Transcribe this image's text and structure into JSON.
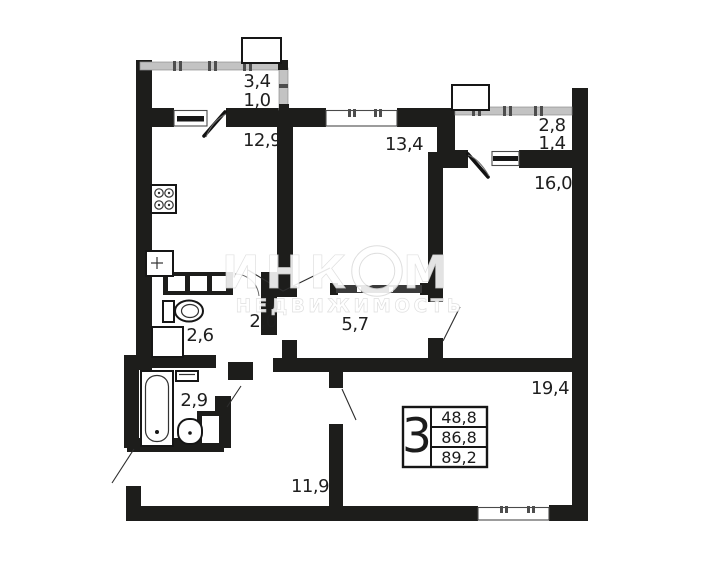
{
  "watermark": {
    "brand_left": "ИНК",
    "brand_right": "М",
    "subtitle": "НЕДВИЖИМОСТЬ"
  },
  "summary": {
    "room_count": "3",
    "living_area": "48,8",
    "apartment_area": "86,8",
    "total_area": "89,2"
  },
  "rooms": {
    "balcony_left": {
      "area": "3,4",
      "area_reduced": "1,0"
    },
    "kitchen": {
      "area": "12,9"
    },
    "bedroom": {
      "area": "13,4"
    },
    "balcony_right": {
      "area": "2,8",
      "area_reduced": "1,4"
    },
    "room_right": {
      "area": "16,0"
    },
    "wc": {
      "area": "2,6"
    },
    "hall_small": {
      "area": "2,0"
    },
    "corridor": {
      "area": "5,7"
    },
    "bathroom": {
      "area": "2,9"
    },
    "hallway": {
      "area": "11,9"
    },
    "living_room": {
      "area": "19,4"
    }
  },
  "colors": {
    "wall": "#1d1d1b",
    "railing": "#c3c3c3",
    "background": "#ffffff",
    "watermark": "#ffffff"
  }
}
